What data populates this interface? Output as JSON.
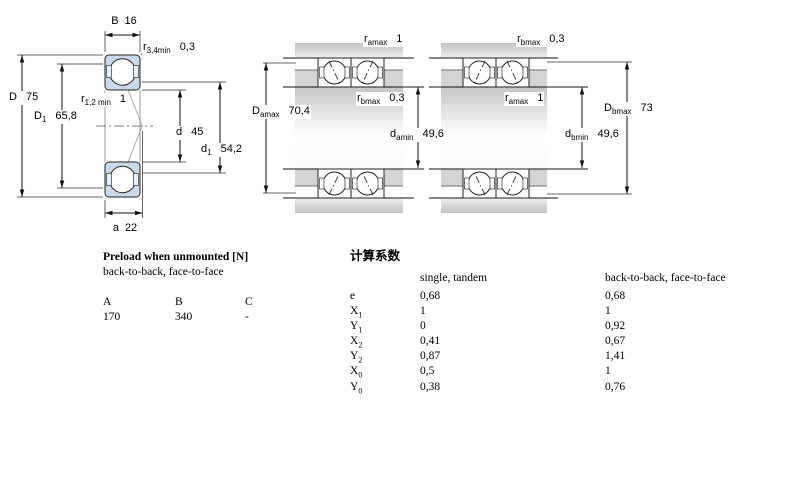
{
  "drawing": {
    "left": {
      "B": {
        "base": "B",
        "value": "16"
      },
      "r34": {
        "base": "r",
        "sub": "3,4min",
        "value": "0,3"
      },
      "D": {
        "base": "D",
        "value": "75"
      },
      "D1": {
        "base": "D",
        "sub": "1",
        "value": "65,8"
      },
      "r12": {
        "base": "r",
        "sub": "1,2 min",
        "value": "1"
      },
      "d": {
        "base": "d",
        "value": "45"
      },
      "d1": {
        "base": "d",
        "sub": "1",
        "value": "54,2"
      },
      "a": {
        "base": "a",
        "value": "22"
      }
    },
    "middle": {
      "r_a_top": {
        "base": "r",
        "sub": "amax",
        "value": "1"
      },
      "D_amax": {
        "base": "D",
        "sub": "amax",
        "value": "70,4"
      },
      "r_b": {
        "base": "r",
        "sub": "bmax",
        "value": "0,3"
      },
      "d_amin": {
        "base": "d",
        "sub": "amin",
        "value": "49,6"
      }
    },
    "right": {
      "r_b_top": {
        "base": "r",
        "sub": "bmax",
        "value": "0,3"
      },
      "r_a": {
        "base": "r",
        "sub": "amax",
        "value": "1"
      },
      "D_bmax": {
        "base": "D",
        "sub": "bmax",
        "value": "73"
      },
      "d_bmin": {
        "base": "d",
        "sub": "bmin",
        "value": "49,6"
      }
    },
    "colors": {
      "ring_blue": "#c8daeb",
      "housing_gray": "#cacaca",
      "line_black": "#1a1a1a"
    }
  },
  "preload_table": {
    "title": "Preload when unmounted [N]",
    "subtitle": "back-to-back, face-to-face",
    "columns": [
      "A",
      "B",
      "C"
    ],
    "values": [
      "170",
      "340",
      "-"
    ]
  },
  "factors_table": {
    "title": "计算系数",
    "col1_header": "single, tandem",
    "col2_header": "back-to-back, face-to-face",
    "rows": [
      {
        "label": {
          "base": "e",
          "sub": ""
        },
        "single": "0,68",
        "paired": "0,68"
      },
      {
        "label": {
          "base": "X",
          "sub": "1"
        },
        "single": "1",
        "paired": "1"
      },
      {
        "label": {
          "base": "Y",
          "sub": "1"
        },
        "single": "0",
        "paired": "0,92"
      },
      {
        "label": {
          "base": "X",
          "sub": "2"
        },
        "single": "0,41",
        "paired": "0,67"
      },
      {
        "label": {
          "base": "Y",
          "sub": "2"
        },
        "single": "0,87",
        "paired": "1,41"
      },
      {
        "label": {
          "base": "X",
          "sub": "0"
        },
        "single": "0,5",
        "paired": "1"
      },
      {
        "label": {
          "base": "Y",
          "sub": "0"
        },
        "single": "0,38",
        "paired": "0,76"
      }
    ]
  }
}
